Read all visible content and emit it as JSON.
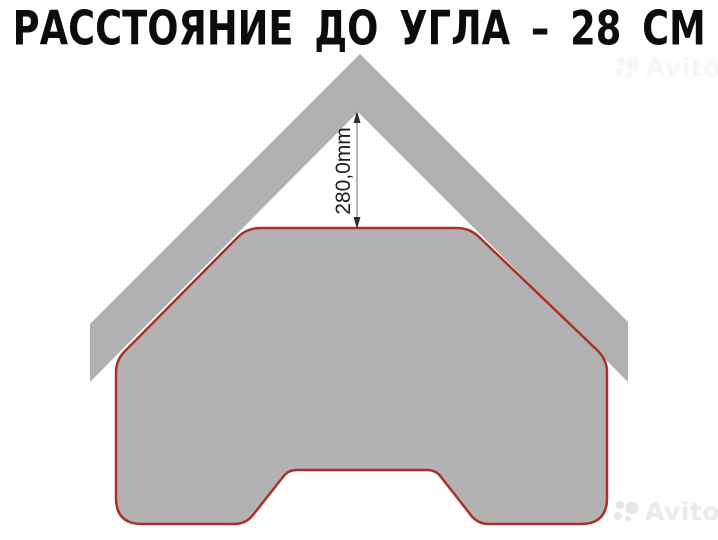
{
  "title": "РАССТОЯНИЕ ДО УГЛА – 28 СМ",
  "diagram": {
    "dimension_label": "280,0mm",
    "dimension_value_mm": 280.0,
    "distance_to_corner_cm": 28,
    "shapes": {
      "corner_shape": "gray angled wall/corner chevron",
      "mat_shape": "gray mat outlined in red with central bottom notch"
    }
  },
  "colors": {
    "title_black": "#0c0c0c",
    "corner_gray": "#b1b1b3",
    "mat_gray": "#b3b1b2",
    "outline_red": "#a8322a",
    "dim_line_gray": "#6e6e6e",
    "dim_arrow_dark": "#2e2e2e",
    "dim_text_dark": "#1e1e1e",
    "watermark_light_gray": "#eaeaea"
  },
  "watermark": {
    "text": "Avito",
    "logo_icon": "avito-dots-logo"
  }
}
